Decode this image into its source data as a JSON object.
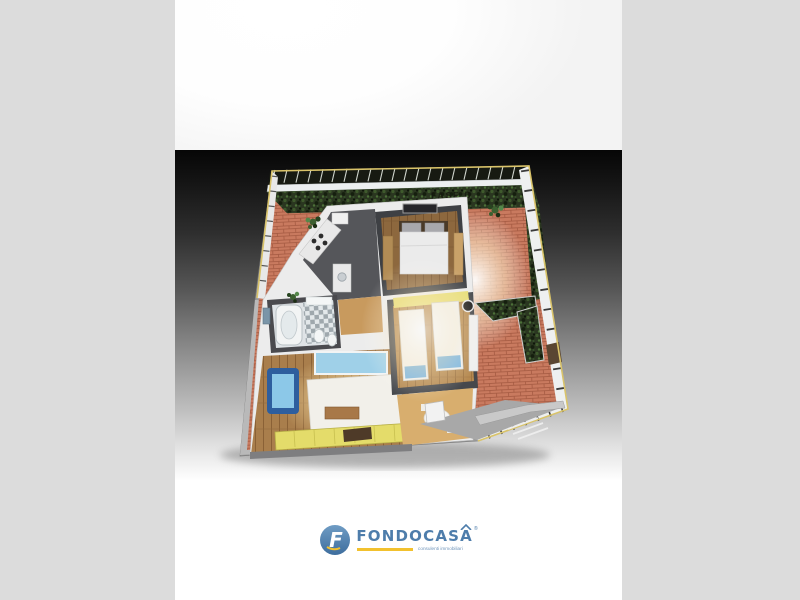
{
  "branding": {
    "name": "FONDOCASA",
    "tagline": "consulenti immobiliari",
    "registered_mark": "®",
    "logo_icon": "fondocasa-f-circle-icon",
    "colors": {
      "blue": "#4e7dab",
      "yellow": "#f2c12e"
    }
  },
  "render": {
    "hedge_watermark": "FASE D",
    "palette": {
      "letterbox_gray": "#dcdcdc",
      "gradient_top": "#060606",
      "gradient_bottom": "#ffffff",
      "terrace_brick": "#c97a5f",
      "hedge_green": "#2a3620",
      "frame_yellow": "#d9c36a",
      "wall_white": "#ececec",
      "wood_floor": "#a97e4c",
      "armchair_blue": "#8cc8e8",
      "sideboard_yellow": "#e4dc6a"
    }
  }
}
